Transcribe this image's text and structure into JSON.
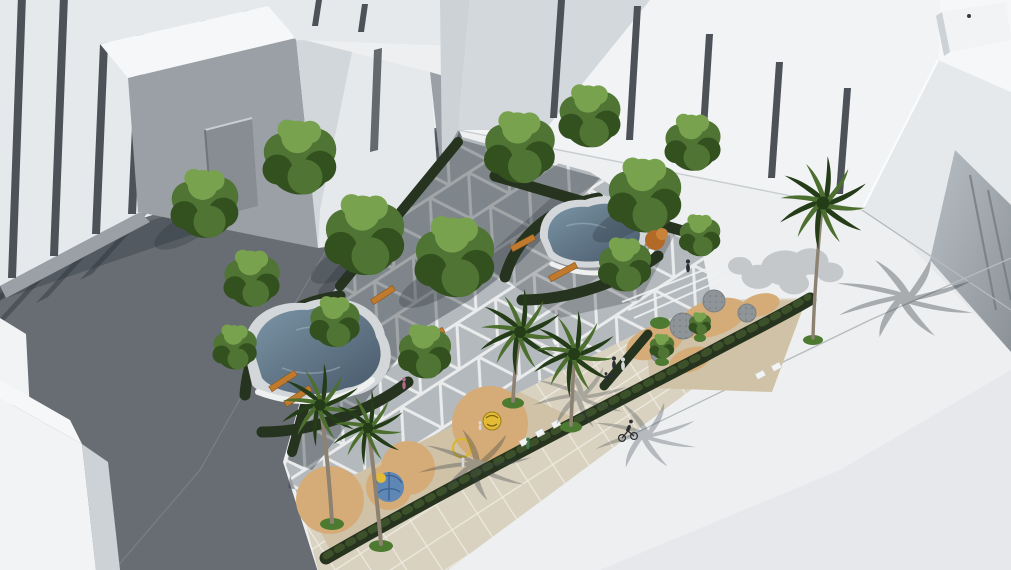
{
  "scene": {
    "title": "Aerial architectural rendering of a pocket-park plaza surrounded by white massing buildings",
    "labels": {
      "scene": "Aerial rendering of an urban pocket park between white model buildings",
      "buildings_left": "White massing buildings with pilasters, upper left",
      "buildings_center": "White massing building with slot windows, top center",
      "buildings_right": "White massing tower with grooved facade, right",
      "building_corner": "White corner building, lower left",
      "street_dark": "Shaded street, lower left",
      "street_light": "Sunlit street and sidewalk, lower right",
      "park": "Pocket park with triangular paving pattern",
      "pond_left": "Organic-shaped reflecting pool, lower plaza",
      "pond_upper": "Organic-shaped reflecting pool, upper plaza",
      "playground_right": "Sand playground with circular pads, east side",
      "playground_bottom": "Sand playground with play equipment, south side",
      "hedges": "Clipped dark green hedges along park edges",
      "trees": "Deciduous shade trees",
      "palms": "Royal palm trees",
      "benches": "Timber benches",
      "people": "Pedestrians and a cyclist"
    },
    "inventory": {
      "deciduous_trees": 15,
      "palm_trees": 5,
      "ponds": 2,
      "benches": 6,
      "playgrounds": 2,
      "play_equipment": [
        "yellow spinner",
        "yellow ring",
        "blue climbing dome"
      ],
      "people": 9,
      "cyclists": 1
    },
    "palette": {
      "ambient": "#e9ebed",
      "street_light": "#edeff1",
      "street_light_dim": "#e3e6e9",
      "street_dark": "#686d73",
      "gutter": "#7d8389",
      "curb": "#b5babd",
      "paving": "#b4b9bd",
      "paving_line": "#f0f1f1",
      "sidewalk": "#d9d2c1",
      "sidewalk_line": "#efebe0",
      "playground": "#cfc2a6",
      "sand": "#d5ac77",
      "pad": "#8e9498",
      "pad_dot": "#6f757b",
      "hedge_dark": "#26331f",
      "hedge_light": "#3c5129",
      "tree_dark": "#33501f",
      "tree_mid": "#4f7433",
      "tree_light": "#79a24e",
      "palm_dark": "#243c18",
      "palm_mid": "#4c6e2e",
      "trunk": "#8d8271",
      "stone": "#d3d7d9",
      "water_deep": "#48596a",
      "water_light": "#7b95a6",
      "pool_wall": "#eff1f1",
      "bench": "#c07a2e",
      "toy_yellow": "#e3bb35",
      "toy_blue": "#5f87b5",
      "shadow": "#2b343b",
      "building_lit": "#f1f3f5",
      "building_mid": "#e6e9ec",
      "building_shaded": "#9aa0a6",
      "building_side": "#ccd2d6",
      "roof": "#f5f7f8",
      "slot": "#4c5258",
      "groove_hi": "#b7bec4",
      "groove_lo": "#8b9298",
      "person_dark": "#2b2f34",
      "person_pink": "#b56a8c",
      "person_green": "#3e7a4b",
      "person_light": "#d7dadc",
      "accent_bush": "#b26a26"
    }
  }
}
